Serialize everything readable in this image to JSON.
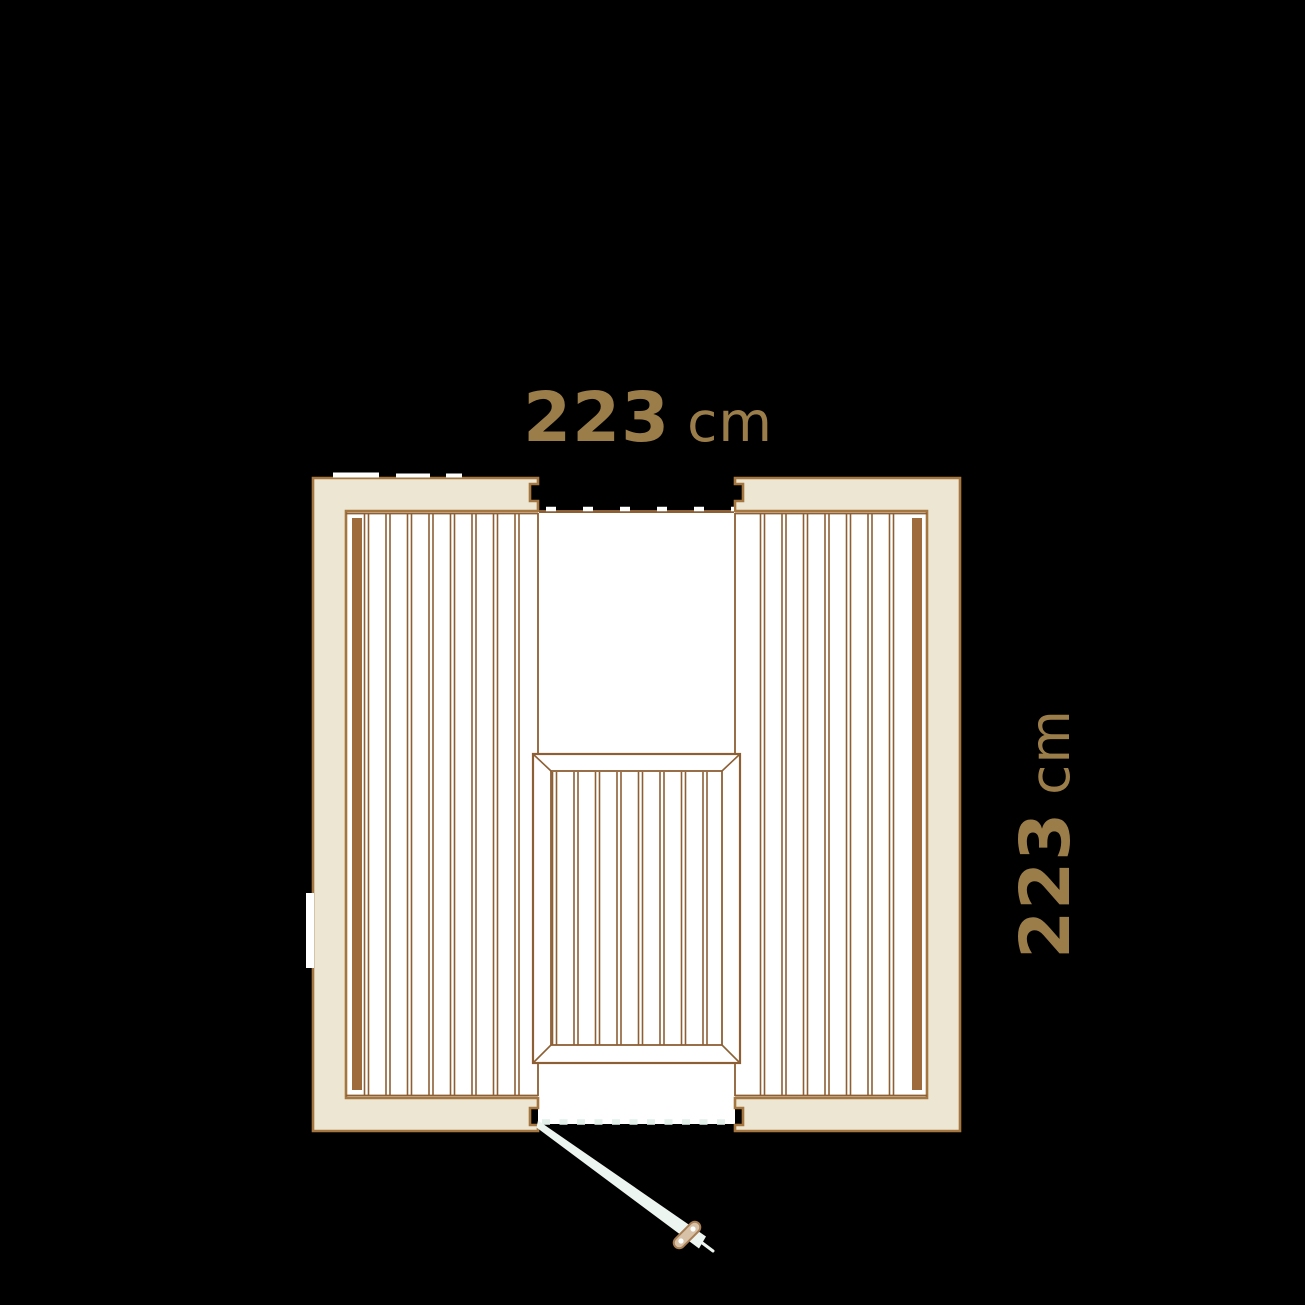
{
  "canvas": {
    "background": "#000000"
  },
  "labels": {
    "width": {
      "value": "223",
      "unit": "cm"
    },
    "depth": {
      "value": "223",
      "unit": "cm"
    }
  },
  "colors": {
    "dimension_text": "#9B7D4A",
    "wall_fill": "#ECE6D3",
    "outline_brown": "#8D5F35",
    "wall_stroke": "#A5763F",
    "bench_bar_brown": "#9E6B3C",
    "floor_white": "#FFFFFF",
    "glass_light": "#E3F0EA",
    "door_panel": "#EDF5F0",
    "handle_fill": "#D8C2A7",
    "handle_stroke": "#A87E54"
  },
  "floor_plan": {
    "type": "sauna-floor-plan-top-view",
    "outer_width_cm": "223",
    "outer_depth_cm": "223",
    "features": [
      "left bench with vertical wood slats",
      "right bench with vertical wood slats",
      "center lower bench with mitered frame and slats",
      "glass panel across top opening (dashed line)",
      "glass door at bottom opening shown swung open with handle"
    ]
  }
}
